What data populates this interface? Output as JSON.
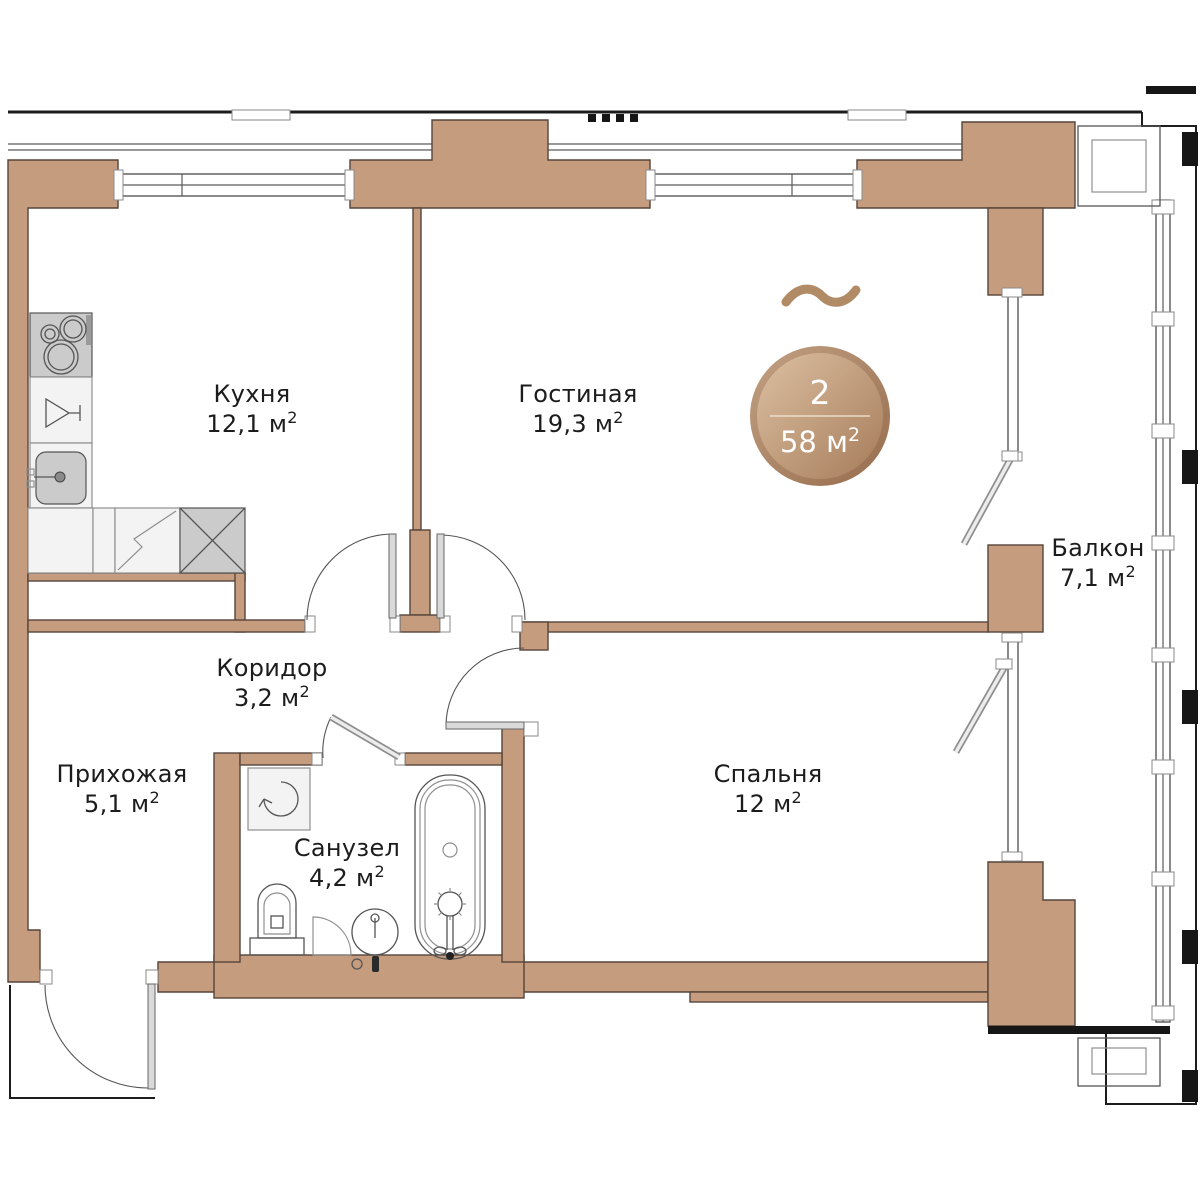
{
  "plan": {
    "type": "apartment-floor-plan",
    "language": "ru",
    "colors": {
      "wall": "#c69c7e",
      "badge_light": "#dcc0a2",
      "badge_dark": "#a67c5a",
      "badge_rim": "#9e7554",
      "squiggle": "#b18a66",
      "text": "#1c1c1c"
    },
    "rooms": [
      {
        "name": "Кухня",
        "area": "12,1 м",
        "sup": "2"
      },
      {
        "name": "Гостиная",
        "area": "19,3 м",
        "sup": "2"
      },
      {
        "name": "Коридор",
        "area": "3,2 м",
        "sup": "2"
      },
      {
        "name": "Прихожая",
        "area": "5,1 м",
        "sup": "2"
      },
      {
        "name": "Санузел",
        "area": "4,2 м",
        "sup": "2"
      },
      {
        "name": "Спальня",
        "area": "12 м",
        "sup": "2"
      },
      {
        "name": "Балкон",
        "area": "7,1 м",
        "sup": "2"
      }
    ],
    "badge": {
      "rooms_count": "2",
      "total_area": "58 м",
      "sup": "2"
    },
    "fixtures": [
      "stove-icon",
      "glass-cabinet-icon",
      "kitchen-sink-icon",
      "dishwasher-icon",
      "fridge-icon",
      "washing-machine-icon",
      "toilet-icon",
      "corner-unit-icon",
      "washbasin-icon",
      "bathtub-icon"
    ]
  }
}
